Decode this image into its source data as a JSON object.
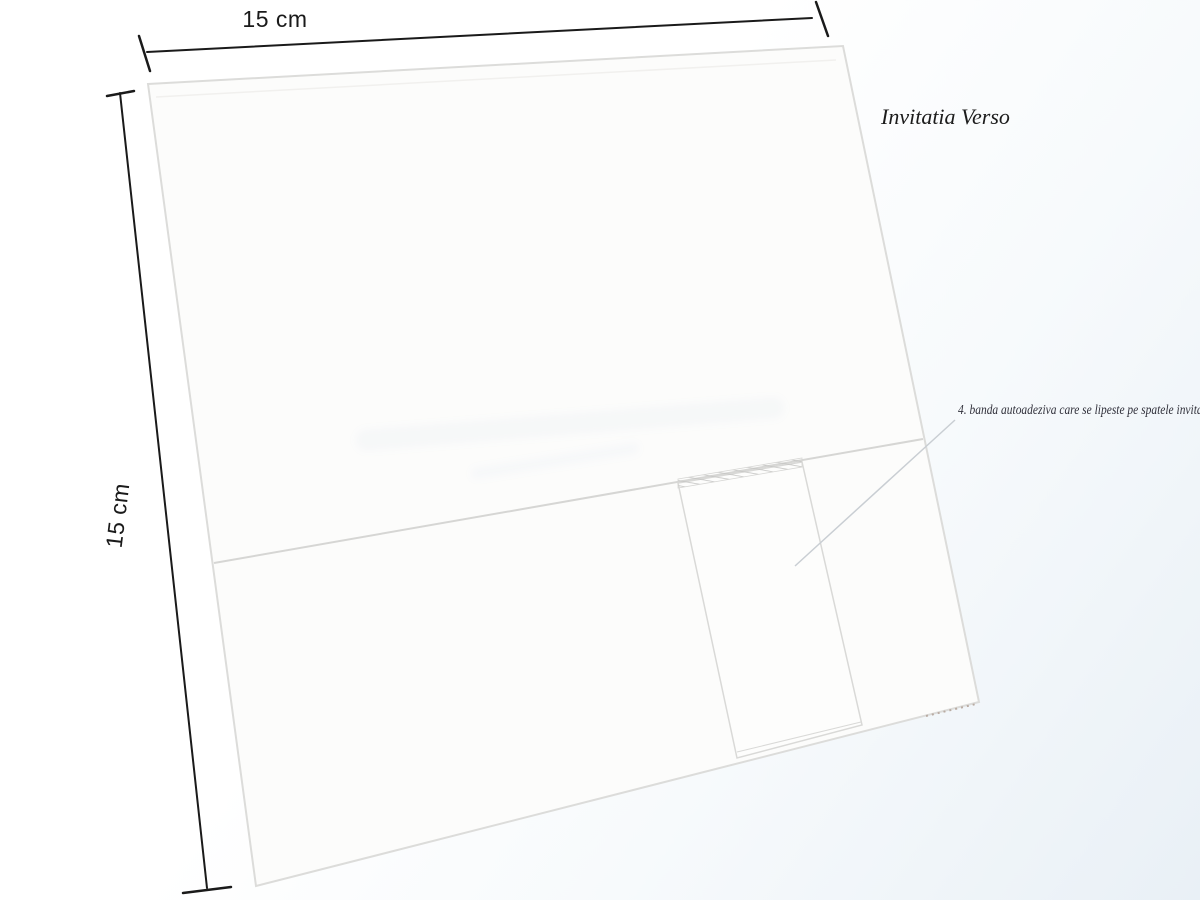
{
  "diagram": {
    "title": "Invitatia Verso",
    "dimensions": {
      "top_label": "15 cm",
      "left_label": "15 cm"
    },
    "annotation": "4. banda autoadeziva care se lipeste pe spatele invitatiei",
    "colors": {
      "dimension-ink": "#1a1a1a",
      "title-ink": "#1c1c1c",
      "annotation-ink": "#30303a",
      "card-fill": "#fcfcfb",
      "card-edge": "#dcdcda",
      "fold-line": "#d6d6d4",
      "band-fill": "#fdfdfc",
      "band-edge": "#d9d9d7",
      "leader-line": "#c9ced3",
      "perforation": "#b9aba2",
      "wash": "#e9f0f6"
    }
  }
}
